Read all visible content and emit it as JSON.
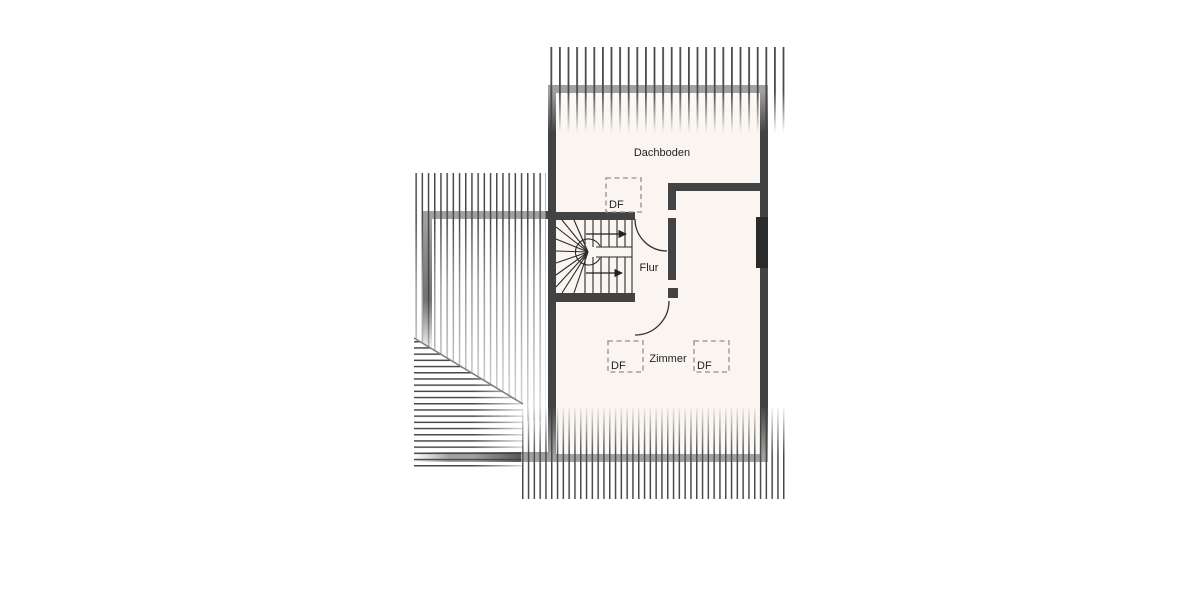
{
  "plan": {
    "rooms": [
      {
        "id": "attic",
        "label": "Dachboden"
      },
      {
        "id": "hallway",
        "label": "Flur"
      },
      {
        "id": "room",
        "label": "Zimmer"
      }
    ],
    "roof_windows": [
      {
        "id": "df-top",
        "label": "DF"
      },
      {
        "id": "df-bottom-left",
        "label": "DF"
      },
      {
        "id": "df-bottom-right",
        "label": "DF"
      }
    ],
    "colors": {
      "background": "#ffffff",
      "room_fill": "#faf5f0",
      "wall": "#434343",
      "chimney": "#2b2b2b",
      "hatch_line": "#4a4a4a",
      "dashed_outline": "#909090",
      "text": "#1f1f1f"
    }
  }
}
